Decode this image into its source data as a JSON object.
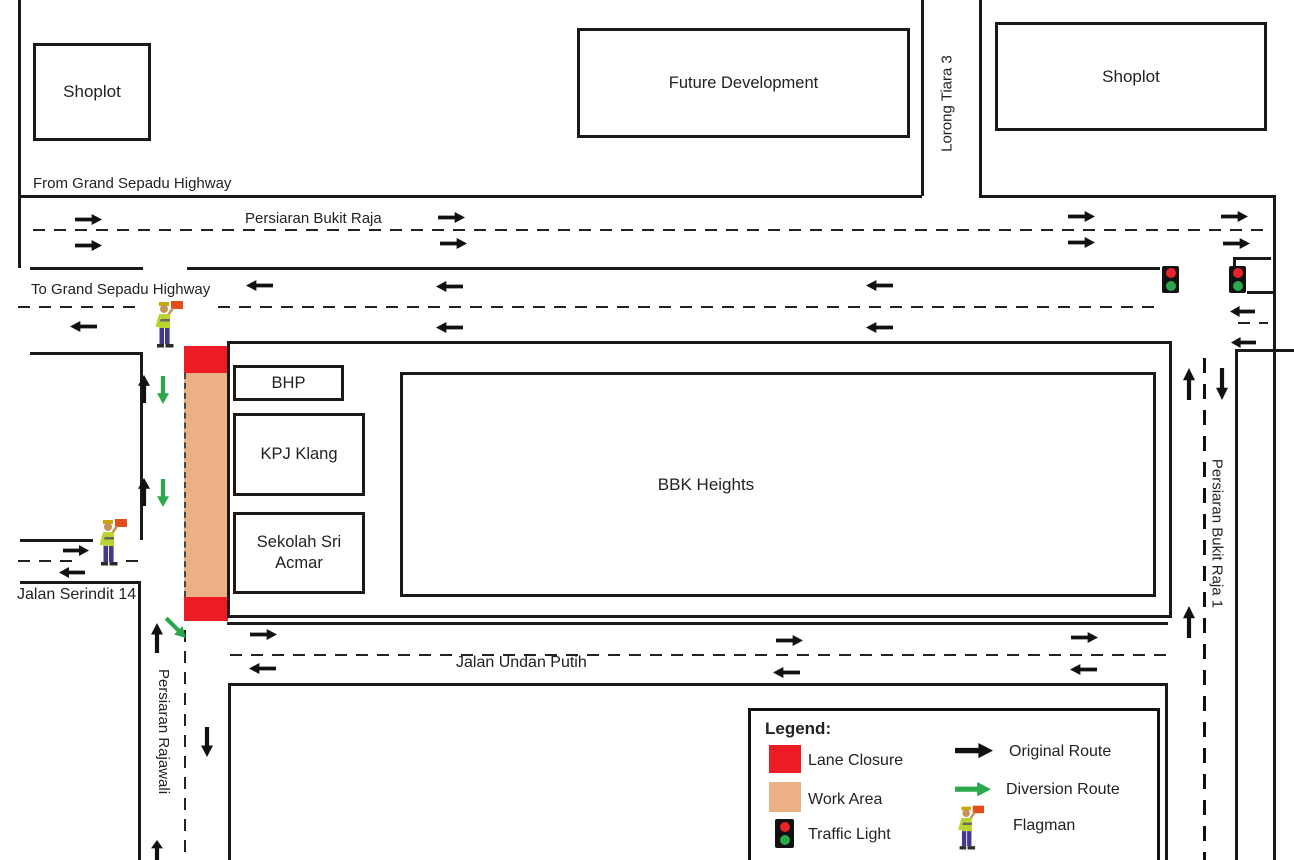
{
  "buildings": {
    "shoplot_left": "Shoplot",
    "future_development": "Future Development",
    "shoplot_right": "Shoplot",
    "bhp": "BHP",
    "kpj_klang": "KPJ Klang",
    "sekolah_line1": "Sekolah Sri",
    "sekolah_line2": "Acmar",
    "bbk_heights": "BBK Heights"
  },
  "roads": {
    "from_grand_sepadu": "From Grand Sepadu Highway",
    "persiaran_bukit_raja": "Persiaran Bukit Raja",
    "to_grand_sepadu": "To Grand Sepadu Highway",
    "lorong_tiara_3": "Lorong Tiara 3",
    "jalan_serindit_14": "Jalan Serindit 14",
    "persiaran_rajawali": "Persiaran Rajawali",
    "jalan_undan_putih": "Jalan Undan Putih",
    "persiaran_bukit_raja_1": "Persiaran Bukit Raja 1"
  },
  "legend": {
    "title": "Legend:",
    "items": [
      {
        "icon": "lane-closure-swatch",
        "label": "Lane Closure"
      },
      {
        "icon": "work-area-swatch",
        "label": "Work Area"
      },
      {
        "icon": "traffic-light-icon",
        "label": "Traffic Light"
      },
      {
        "icon": "original-route-arrow",
        "label": "Original Route"
      },
      {
        "icon": "diversion-route-arrow",
        "label": "Diversion Route"
      },
      {
        "icon": "flagman-icon",
        "label": "Flagman"
      }
    ]
  },
  "colors": {
    "lane_closure": "#ED1C24",
    "work_area": "#EBB185",
    "original_route": "#111111",
    "diversion_route": "#2BA84C",
    "traffic_light_red": "#E8212A",
    "traffic_light_green": "#2BA84C"
  }
}
